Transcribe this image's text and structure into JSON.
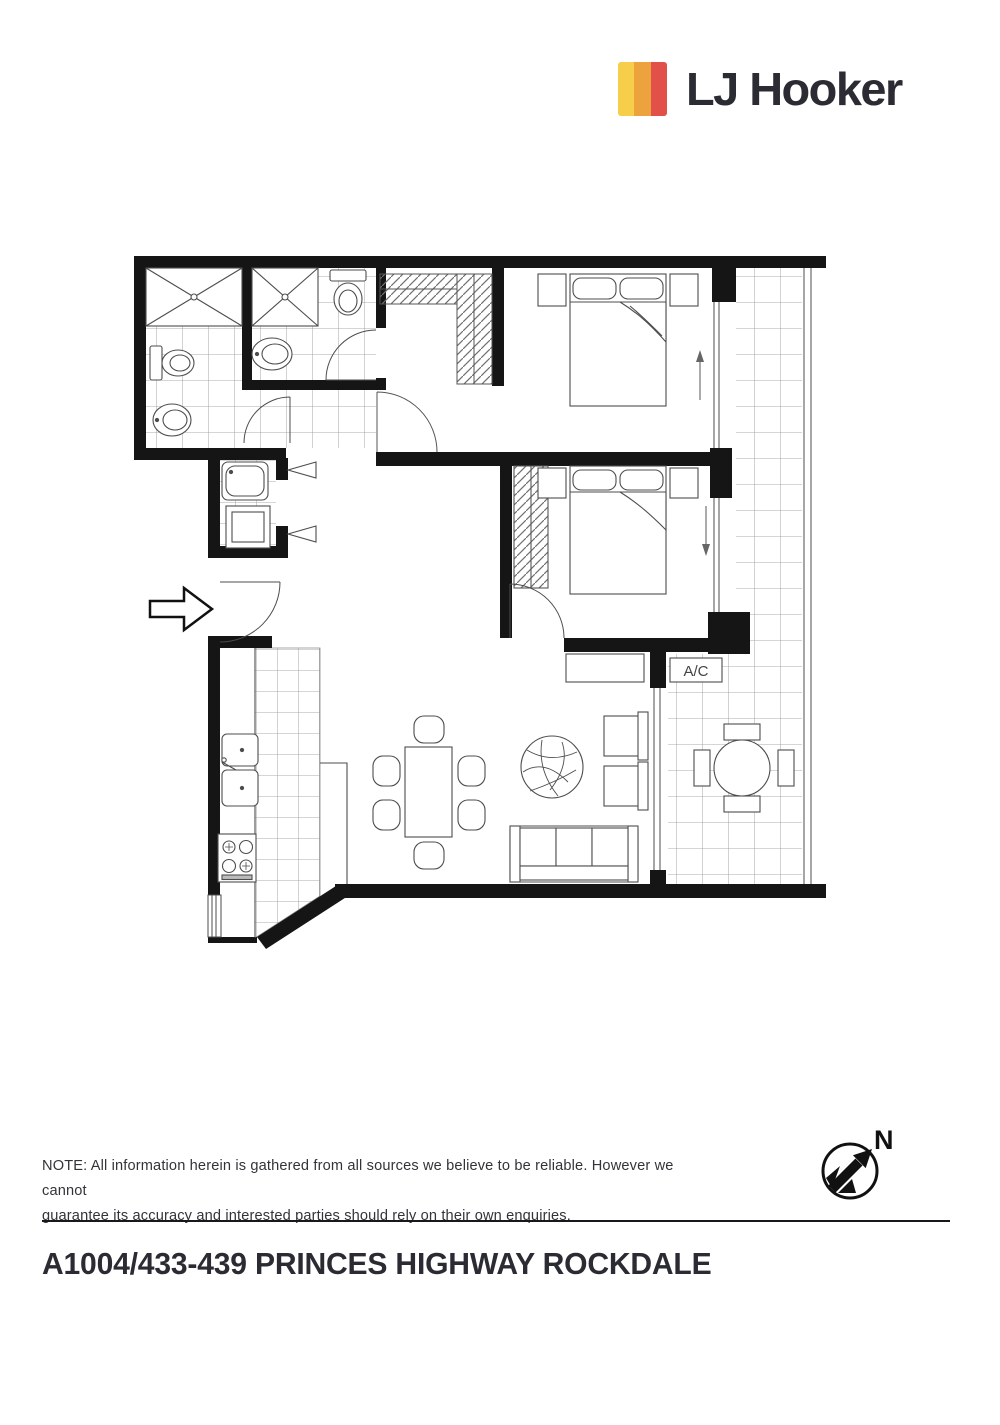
{
  "header": {
    "brand": "LJ Hooker"
  },
  "colors": {
    "stripe-yellow": "#F7CE4A",
    "stripe-amber": "#ECA33D",
    "stripe-red": "#E2504A",
    "ink": "#2B2B33"
  },
  "floor_plan": {
    "ac_label": "A/C",
    "compass_label": "N"
  },
  "footer": {
    "note_lines": [
      "NOTE: All information herein is gathered from all sources we believe to be reliable. However we cannot",
      "guarantee its accuracy and interested parties should rely on their own enquiries."
    ],
    "address": "A1004/433-439 PRINCES HIGHWAY ROCKDALE"
  }
}
